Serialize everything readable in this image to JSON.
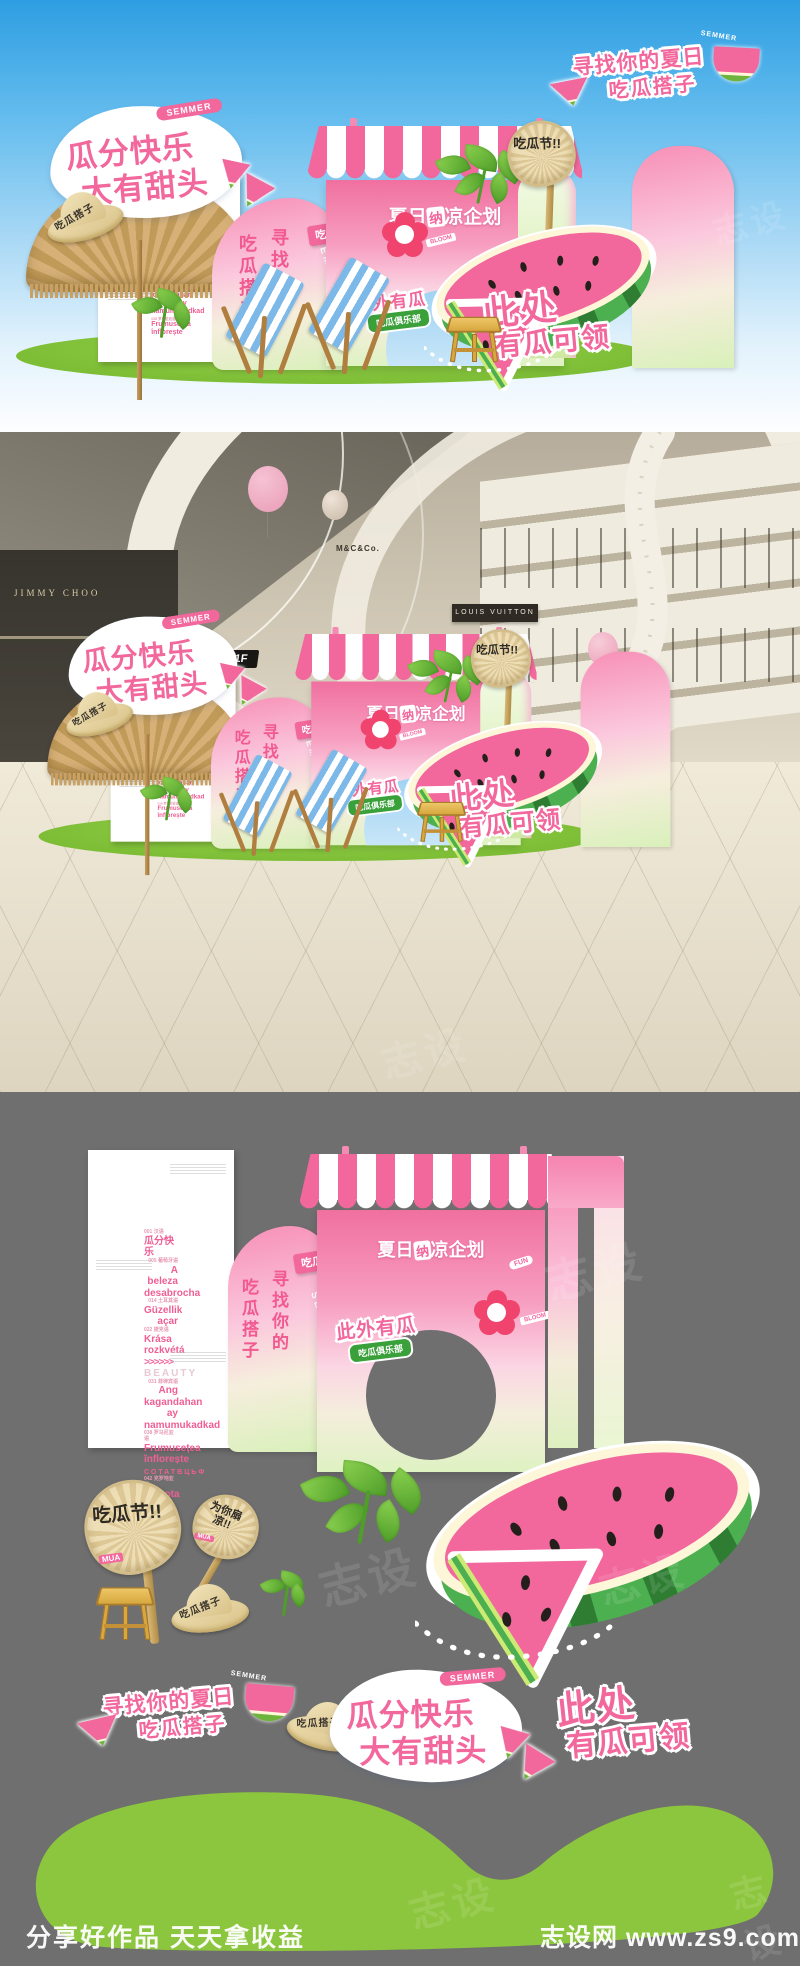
{
  "watermark": "志设",
  "semmer": "SEMMER",
  "footer": {
    "left": "分享好作品 天天拿收益",
    "site": "志设网 www.zs9.com"
  },
  "design": {
    "find_badge": {
      "line1": "寻找你的夏日",
      "line2": "吃瓜搭子"
    },
    "title": {
      "line1": "瓜分快乐",
      "line2": "大有甜头"
    },
    "hat_text": "吃瓜搭子",
    "booth": {
      "title_pre": "夏日",
      "title_chip": "纳",
      "title_post": "凉企划",
      "tag": "FUN"
    },
    "crowd_tag": "吃瓜群众",
    "vertical": {
      "left": "吃瓜搭子",
      "right": "寻找你的"
    },
    "melon_badge": "此外有瓜",
    "club_badge": "吃瓜俱乐部",
    "flower_tag": "BLOOM",
    "claim": {
      "line1": "此处",
      "line2": "有瓜可领"
    },
    "fans": {
      "festival": "吃瓜节!!",
      "festival_tag": "MUA",
      "cool": "为你扇凉!!"
    },
    "panel": {
      "items": [
        {
          "label": "001 汉语",
          "text": "瓜分快乐"
        },
        {
          "label": "005 葡萄牙语",
          "text": "A beleza desabrocha"
        },
        {
          "label": "014 土耳其语",
          "text": "Güzellik açar"
        },
        {
          "label": "022 捷克语",
          "text": "Krása rozkvétá"
        },
        {
          "label": "",
          "text": ">>>>>>"
        },
        {
          "label": "",
          "text": "BEAUTY"
        },
        {
          "label": "031 菲律宾语",
          "text": "Ang kagandahan ay namumukadkad"
        },
        {
          "label": "038 罗马尼亚语",
          "text": "Frumusețea înflorește"
        },
        {
          "label": "",
          "text": "СОТАТВЦЬФ"
        },
        {
          "label": "042 克罗地亚语",
          "text": "Ljepota cvjeta"
        }
      ]
    }
  },
  "mall": {
    "floor_sign": "1F",
    "store_left": "JIMMY CHOO",
    "store_right": "LOUIS VUITTON",
    "store_center": "M&C&Co."
  },
  "colors": {
    "pink": "#F2679C",
    "green": "#8CC63E",
    "sky": "#2F9EE2",
    "gray": "#6F6F6F",
    "straw": "#E4D2A6"
  }
}
